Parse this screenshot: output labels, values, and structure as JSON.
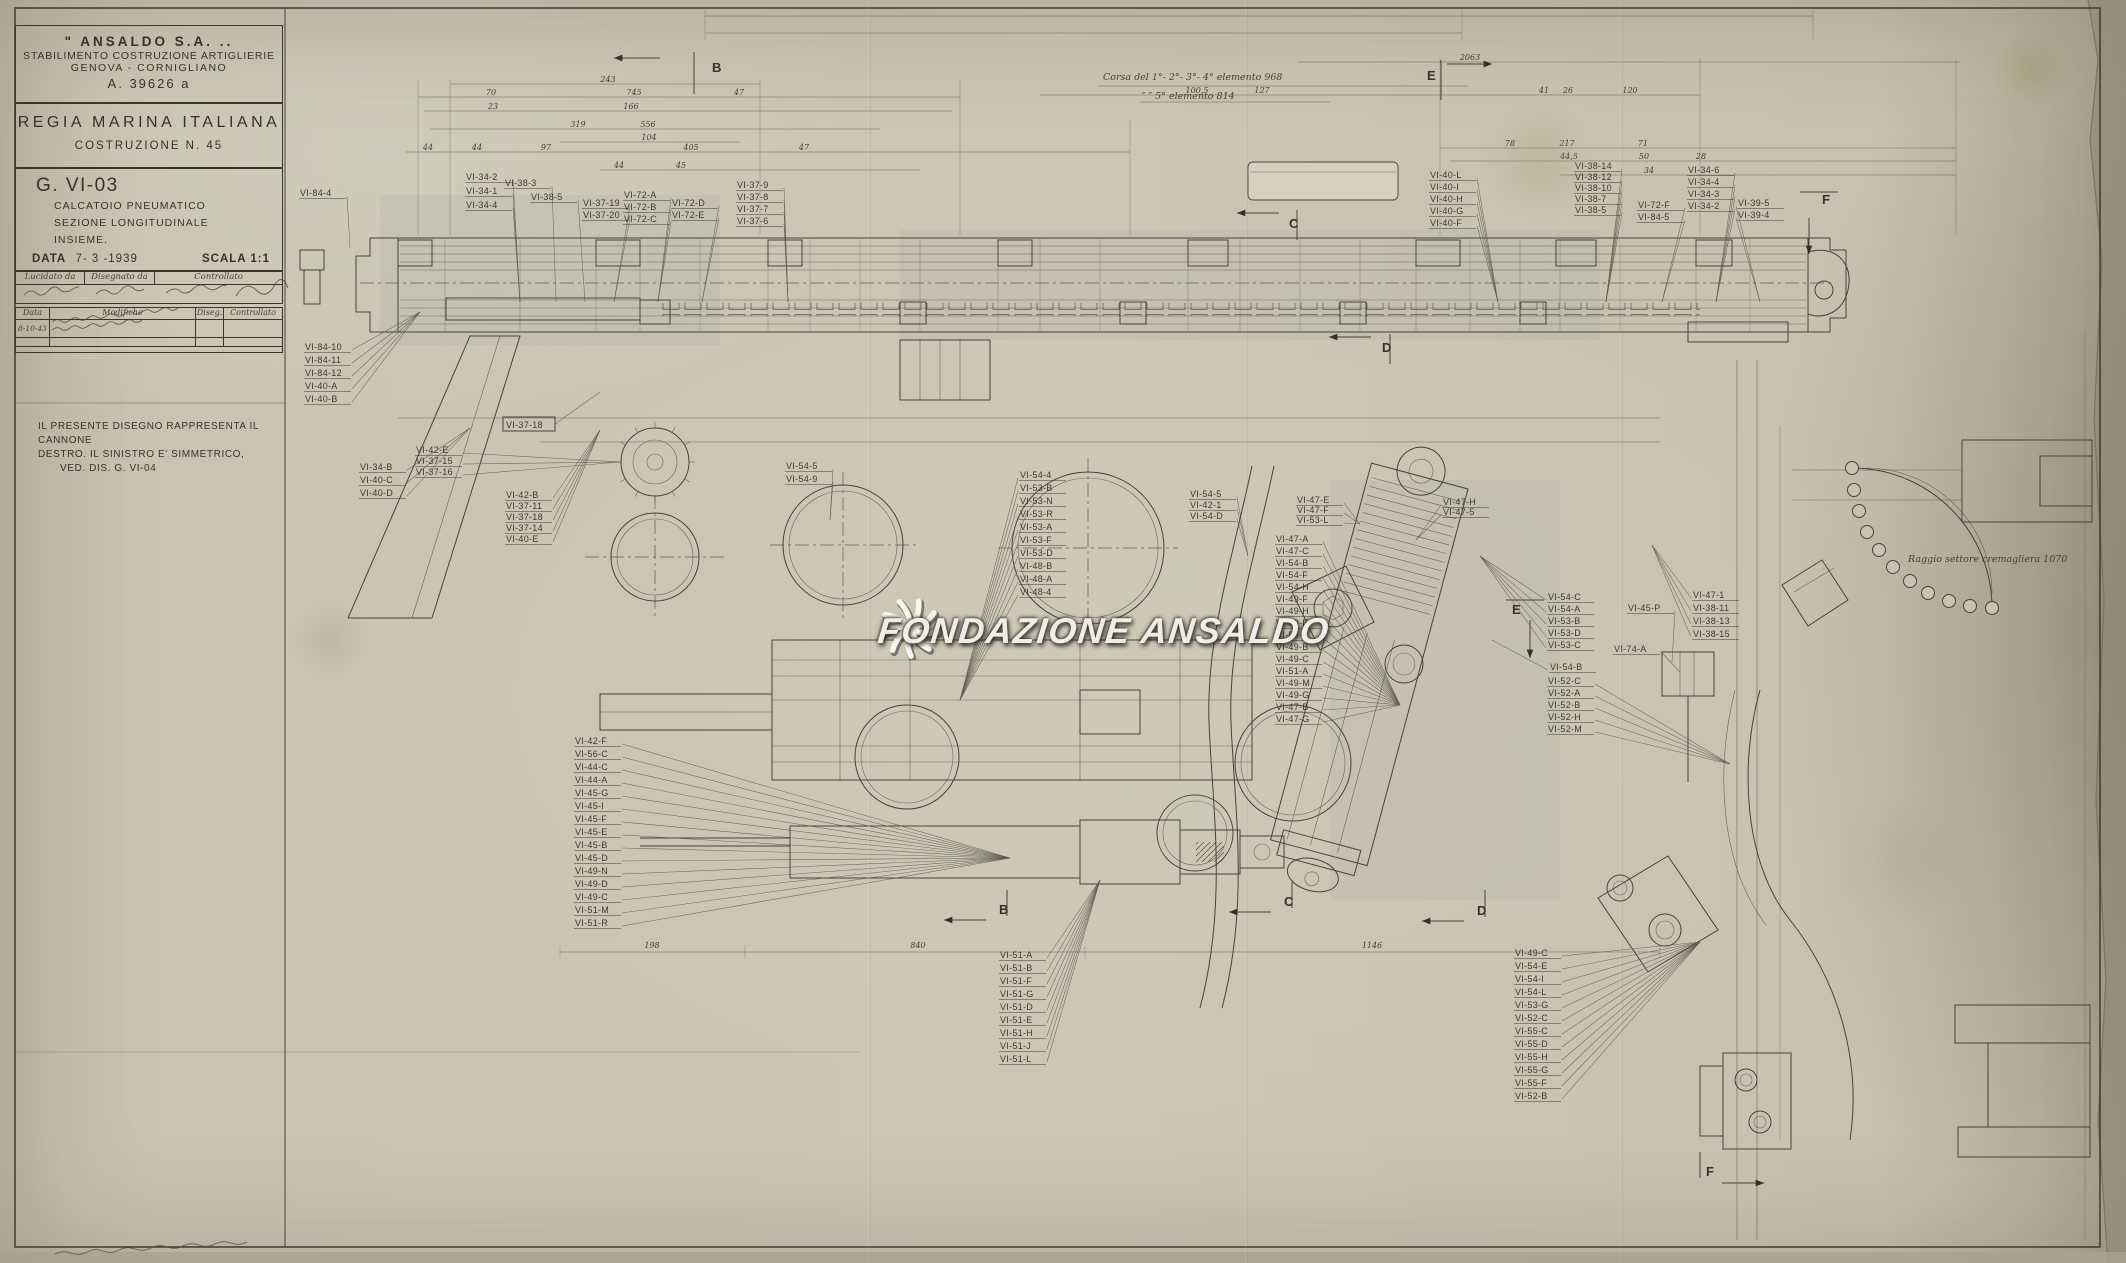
{
  "sheet": {
    "company": "\" ANSALDO  S.A. ..",
    "division": "STABILIMENTO COSTRUZIONE ARTIGLIERIE",
    "location": "GENOVA - CORNIGLIANO",
    "code": "A. 39626 a",
    "authority": "REGIA MARINA ITALIANA",
    "construction": "COSTRUZIONE  N. 45",
    "drawing_no": "G. VI-03",
    "subject1": "CALCATOIO  PNEUMATICO",
    "subject2": "SEZIONE  LONGITUDINALE",
    "subject3": "INSIEME.",
    "date_label": "DATA",
    "date_value": "7- 3 -1939",
    "scale_label": "SCALA",
    "scale_value": "1:1",
    "sig_headers": [
      "Lucidato da",
      "Disegnato da",
      "Controllato"
    ],
    "rev_headers": [
      "Data",
      "Modifiche",
      "Diseg.",
      "Controllato"
    ],
    "rev_row_date": "8-10-43"
  },
  "note_lines": [
    "IL  PRESENTE  DISEGNO  RAPPRESENTA  IL CANNONE",
    "DESTRO. IL  SINISTRO  E'  SIMMETRICO,",
    "VED. DIS. G. VI-04"
  ],
  "annotations": {
    "corsa1": "Corsa del 1°- 2°- 3°- 4° elemento  968",
    "corsa2": "″    ″    5° elemento  814",
    "sector": "Raggio settore cremagliera 1070"
  },
  "watermark": {
    "text": "Fondazione Ansaldo",
    "logo": "ansaldo-fan-icon"
  },
  "section_marks": [
    {
      "label": "B",
      "lx": 712,
      "ly": 72,
      "a": [
        660,
        58,
        614,
        58
      ],
      "br": "M694,52 v42"
    },
    {
      "label": "E",
      "lx": 1427,
      "ly": 80,
      "a": [
        1447,
        64,
        1492,
        64
      ],
      "br": "M1441,60 v40"
    },
    {
      "label": "C",
      "lx": 1289,
      "ly": 228,
      "a": [
        1279,
        213,
        1237,
        213
      ],
      "br": "M1297,210 v30"
    },
    {
      "label": "D",
      "lx": 1382,
      "ly": 352,
      "a": [
        1371,
        337,
        1329,
        337
      ],
      "br": "M1390,334 v30"
    },
    {
      "label": "E",
      "lx": 1512,
      "ly": 614,
      "a": [
        1530,
        620,
        1530,
        658
      ],
      "br": "M1506,600 h38"
    },
    {
      "label": "F",
      "lx": 1822,
      "ly": 204,
      "a": [
        1809,
        218,
        1809,
        254
      ],
      "br": "M1800,192 h38"
    },
    {
      "label": "B",
      "lx": 999,
      "ly": 914,
      "a": [
        986,
        920,
        944,
        920
      ],
      "br": "M1007,890 v26"
    },
    {
      "label": "C",
      "lx": 1284,
      "ly": 906,
      "a": [
        1271,
        912,
        1229,
        912
      ],
      "br": "M1292,882 v26"
    },
    {
      "label": "D",
      "lx": 1477,
      "ly": 915,
      "a": [
        1464,
        921,
        1422,
        921
      ],
      "br": "M1485,890 v27"
    },
    {
      "label": "F",
      "lx": 1706,
      "ly": 1176,
      "a": [
        1722,
        1183,
        1764,
        1183
      ],
      "br": "M1700,1152 v26"
    }
  ],
  "dims": [
    {
      "t": "243",
      "x": 608,
      "y": 82
    },
    {
      "t": "70",
      "x": 491,
      "y": 95
    },
    {
      "t": "745",
      "x": 634,
      "y": 95
    },
    {
      "t": "47",
      "x": 739,
      "y": 95
    },
    {
      "t": "23",
      "x": 493,
      "y": 109
    },
    {
      "t": "166",
      "x": 631,
      "y": 109
    },
    {
      "t": "319",
      "x": 578,
      "y": 127
    },
    {
      "t": "556",
      "x": 648,
      "y": 127
    },
    {
      "t": "104",
      "x": 649,
      "y": 140
    },
    {
      "t": "44",
      "x": 428,
      "y": 150
    },
    {
      "t": "44",
      "x": 477,
      "y": 150
    },
    {
      "t": "97",
      "x": 546,
      "y": 150
    },
    {
      "t": "405",
      "x": 691,
      "y": 150
    },
    {
      "t": "47",
      "x": 804,
      "y": 150
    },
    {
      "t": "44",
      "x": 619,
      "y": 168
    },
    {
      "t": "45",
      "x": 681,
      "y": 168
    },
    {
      "t": "127",
      "x": 1262,
      "y": 93
    },
    {
      "t": "100,5",
      "x": 1197,
      "y": 93
    },
    {
      "t": "2063",
      "x": 1470,
      "y": 60
    },
    {
      "t": "41",
      "x": 1544,
      "y": 93
    },
    {
      "t": "26",
      "x": 1568,
      "y": 93
    },
    {
      "t": "120",
      "x": 1630,
      "y": 93
    },
    {
      "t": "78",
      "x": 1510,
      "y": 146
    },
    {
      "t": "217",
      "x": 1567,
      "y": 146
    },
    {
      "t": "71",
      "x": 1643,
      "y": 146
    },
    {
      "t": "44,5",
      "x": 1569,
      "y": 159
    },
    {
      "t": "50",
      "x": 1644,
      "y": 159
    },
    {
      "t": "28",
      "x": 1701,
      "y": 159
    },
    {
      "t": "34",
      "x": 1649,
      "y": 173
    },
    {
      "t": "198",
      "x": 652,
      "y": 948
    },
    {
      "t": "840",
      "x": 918,
      "y": 948
    },
    {
      "t": "1146",
      "x": 1372,
      "y": 948
    }
  ],
  "boxed_labels": [
    {
      "t": "VI-37-18",
      "x": 506,
      "y": 427,
      "fx": 600,
      "fy": 392
    }
  ],
  "label_stacks": [
    {
      "name": "s1",
      "x": 466,
      "y": 180,
      "dy": 14,
      "fx": 520,
      "fy": 302,
      "labels": [
        "VI-34-2",
        "VI-34-1",
        "VI-34-4"
      ]
    },
    {
      "name": "s2",
      "x": 505,
      "y": 186,
      "dy": 14,
      "fx": 556,
      "fy": 302,
      "labels": [
        "VI-38-3"
      ]
    },
    {
      "name": "s3",
      "x": 531,
      "y": 200,
      "dy": 14,
      "fx": 585,
      "fy": 302,
      "labels": [
        "VI-38-5"
      ]
    },
    {
      "name": "s4",
      "x": 583,
      "y": 206,
      "dy": 12,
      "fx": 614,
      "fy": 302,
      "labels": [
        "VI-37-19",
        "VI-37-20"
      ]
    },
    {
      "name": "s5",
      "x": 624,
      "y": 198,
      "dy": 12,
      "fx": 658,
      "fy": 302,
      "labels": [
        "VI-72-A",
        "VI-72-B",
        "VI-72-C"
      ]
    },
    {
      "name": "s6",
      "x": 672,
      "y": 206,
      "dy": 12,
      "fx": 702,
      "fy": 302,
      "labels": [
        "VI-72-D",
        "VI-72-E"
      ]
    },
    {
      "name": "s7",
      "x": 737,
      "y": 188,
      "dy": 12,
      "fx": 788,
      "fy": 302,
      "labels": [
        "VI-37-9",
        "VI-37-8",
        "VI-37-7",
        "VI-37-6"
      ]
    },
    {
      "name": "s8",
      "x": 1430,
      "y": 178,
      "dy": 12,
      "fx": 1498,
      "fy": 302,
      "labels": [
        "VI-40-L",
        "VI-40-I",
        "VI-40-H",
        "VI-40-G",
        "VI-40-F"
      ]
    },
    {
      "name": "s9",
      "x": 1575,
      "y": 169,
      "dy": 11,
      "fx": 1606,
      "fy": 302,
      "labels": [
        "VI-38-14",
        "VI-38-12",
        "VI-38-10",
        "VI-38-7",
        "VI-38-5"
      ]
    },
    {
      "name": "s10",
      "x": 1638,
      "y": 208,
      "dy": 12,
      "fx": 1662,
      "fy": 302,
      "labels": [
        "VI-72-F",
        "VI-84-5"
      ]
    },
    {
      "name": "s11",
      "x": 1688,
      "y": 173,
      "dy": 12,
      "fx": 1716,
      "fy": 302,
      "labels": [
        "VI-34-6",
        "VI-34-4",
        "VI-34-3",
        "VI-34-2"
      ]
    },
    {
      "name": "s12",
      "x": 1738,
      "y": 206,
      "dy": 12,
      "fx": 1760,
      "fy": 302,
      "labels": [
        "VI-39-5",
        "VI-39-4"
      ]
    },
    {
      "name": "s13",
      "x": 305,
      "y": 350,
      "dy": 13,
      "fx": 420,
      "fy": 312,
      "labels": [
        "VI-84-10",
        "VI-84-11",
        "VI-84-12",
        "VI-40-A",
        "VI-40-B"
      ]
    },
    {
      "name": "s14",
      "x": 360,
      "y": 470,
      "dy": 13,
      "fx": 470,
      "fy": 428,
      "labels": [
        "VI-34-B",
        "VI-40-C",
        "VI-40-D"
      ]
    },
    {
      "name": "s15",
      "x": 506,
      "y": 498,
      "dy": 11,
      "fx": 600,
      "fy": 430,
      "labels": [
        "VI-42-B",
        "VI-37-11",
        "VI-37-18",
        "VI-37-14",
        "VI-40-E"
      ]
    },
    {
      "name": "s16",
      "x": 416,
      "y": 453,
      "dy": 11,
      "fx": 620,
      "fy": 462,
      "labels": [
        "VI-42-E",
        "VI-37-15",
        "VI-37-16"
      ]
    },
    {
      "name": "s17",
      "x": 786,
      "y": 469,
      "dy": 13,
      "fx": 830,
      "fy": 520,
      "labels": [
        "VI-54-5",
        "VI-54-9"
      ]
    },
    {
      "name": "s18",
      "x": 1020,
      "y": 478,
      "dy": 13,
      "fx": 960,
      "fy": 700,
      "labels": [
        "VI-54-4",
        "VI-53-B",
        "VI-53-N",
        "VI-53-R",
        "VI-53-A",
        "VI-53-F",
        "VI-53-D",
        "VI-48-B",
        "VI-48-A",
        "VI-48-4"
      ]
    },
    {
      "name": "s19",
      "x": 1190,
      "y": 497,
      "dy": 11,
      "fx": 1248,
      "fy": 556,
      "labels": [
        "VI-54-5",
        "VI-42-1",
        "VI-54-D"
      ]
    },
    {
      "name": "s20",
      "x": 1297,
      "y": 503,
      "dy": 10,
      "fx": 1360,
      "fy": 524,
      "labels": [
        "VI-47-E",
        "VI-47-F",
        "VI-53-L"
      ]
    },
    {
      "name": "s21",
      "x": 1443,
      "y": 505,
      "dy": 10,
      "fx": 1416,
      "fy": 540,
      "labels": [
        "VI-47-H",
        "VI-47-5"
      ]
    },
    {
      "name": "s22",
      "x": 1276,
      "y": 542,
      "dy": 12,
      "fx": 1400,
      "fy": 705,
      "labels": [
        "VI-47-A",
        "VI-47-C",
        "VI-54-B",
        "VI-54-F",
        "VI-54-H",
        "VI-49-F",
        "VI-49-H",
        "VI-49-E",
        "VI-55-A",
        "VI-49-B",
        "VI-49-C",
        "VI-51-A",
        "VI-49-M",
        "VI-49-G",
        "VI-47-B",
        "VI-47-G"
      ]
    },
    {
      "name": "s23",
      "x": 1548,
      "y": 600,
      "dy": 12,
      "fx": 1480,
      "fy": 556,
      "labels": [
        "VI-54-C",
        "VI-54-A",
        "VI-53-B",
        "VI-53-D",
        "VI-53-C"
      ]
    },
    {
      "name": "s24",
      "x": 1550,
      "y": 670,
      "dy": 12,
      "fx": 1492,
      "fy": 640,
      "labels": [
        "VI-54-B"
      ]
    },
    {
      "name": "s25",
      "x": 1548,
      "y": 684,
      "dy": 12,
      "fx": 1730,
      "fy": 764,
      "labels": [
        "VI-52-C",
        "VI-52-A",
        "VI-52-B",
        "VI-52-H",
        "VI-52-M"
      ]
    },
    {
      "name": "s26",
      "x": 1628,
      "y": 611,
      "dy": 12,
      "fx": 1672,
      "fy": 662,
      "labels": [
        "VI-45-P"
      ]
    },
    {
      "name": "s27",
      "x": 1614,
      "y": 652,
      "dy": 12,
      "fx": 1680,
      "fy": 672,
      "labels": [
        "VI-74-A"
      ]
    },
    {
      "name": "s28",
      "x": 1693,
      "y": 598,
      "dy": 13,
      "fx": 1652,
      "fy": 545,
      "labels": [
        "VI-47-1",
        "VI-38-11",
        "VI-38-13",
        "VI-38-15"
      ]
    },
    {
      "name": "s29",
      "x": 575,
      "y": 744,
      "dy": 13,
      "fx": 1010,
      "fy": 858,
      "labels": [
        "VI-42-F",
        "VI-56-C",
        "VI-44-C",
        "VI-44-A",
        "VI-45-G",
        "VI-45-I",
        "VI-45-F",
        "VI-45-E",
        "VI-45-B",
        "VI-45-D",
        "VI-49-N",
        "VI-49-D",
        "VI-49-C",
        "VI-51-M",
        "VI-51-R"
      ]
    },
    {
      "name": "s30",
      "x": 1000,
      "y": 958,
      "dy": 13,
      "fx": 1100,
      "fy": 880,
      "labels": [
        "VI-51-A",
        "VI-51-B",
        "VI-51-F",
        "VI-51-G",
        "VI-51-D",
        "VI-51-E",
        "VI-51-H",
        "VI-51-J",
        "VI-51-L"
      ]
    },
    {
      "name": "s31",
      "x": 1515,
      "y": 956,
      "dy": 13,
      "fx": 1700,
      "fy": 942,
      "labels": [
        "VI-49-C",
        "VI-54-E",
        "VI-54-I",
        "VI-54-L",
        "VI-53-G",
        "VI-52-C",
        "VI-55-C",
        "VI-55-D",
        "VI-55-H",
        "VI-55-G",
        "VI-55-F",
        "VI-52-B"
      ]
    },
    {
      "name": "s32",
      "x": 300,
      "y": 196,
      "dy": 13,
      "fx": 350,
      "fy": 248,
      "labels": [
        "VI-84-4"
      ]
    }
  ],
  "colors": {
    "paper": "#c8c3b0",
    "ink": "#45443a",
    "watermark": "#f8f7f0"
  }
}
